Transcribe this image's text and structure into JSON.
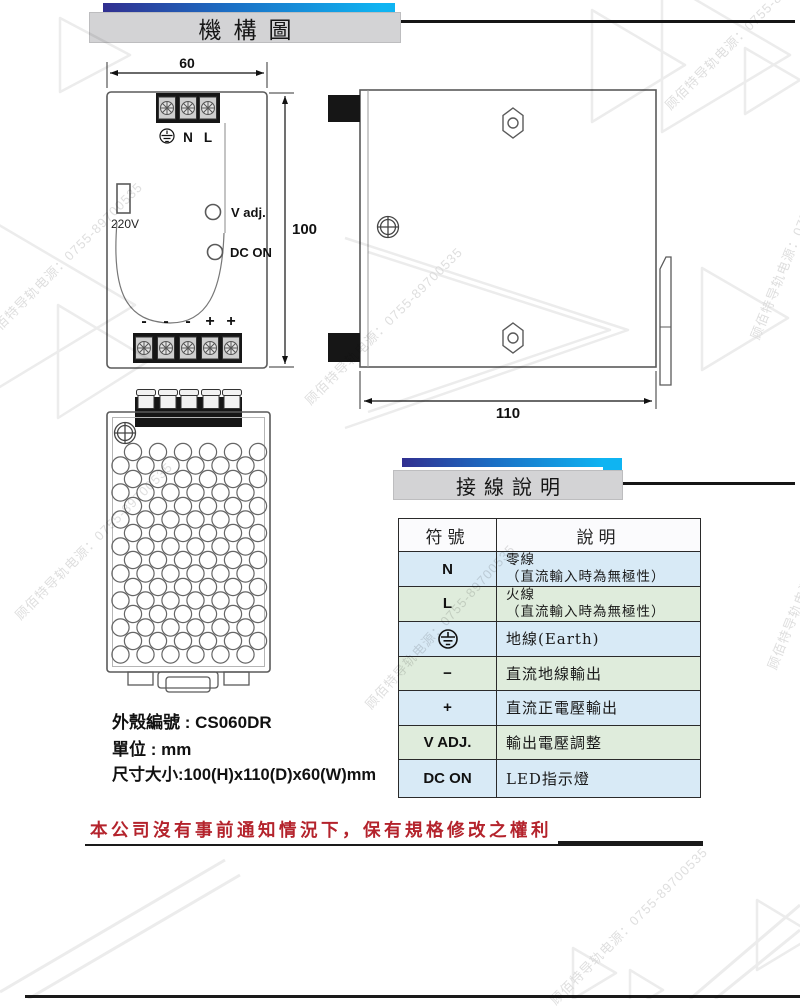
{
  "sections": {
    "mechanical_title": "機構圖",
    "wiring_title": "接線說明"
  },
  "front_view": {
    "dim_width": "60",
    "dim_height": "100",
    "terminal_n": "N",
    "terminal_l": "L",
    "terminal_earth_icon": "earth-ground-icon",
    "voltage_label": "220V",
    "vadj_label": "V adj.",
    "dcon_label": "DC ON",
    "bottom_labels": [
      "-",
      "-",
      "-",
      "+",
      "+"
    ]
  },
  "side_view": {
    "dim_depth": "110",
    "icons": [
      "hex-nut-icon",
      "crosshead-screw-icon",
      "din-rail-clip"
    ]
  },
  "bottom_view": {
    "icons": [
      "crosshead-screw-icon",
      "vent-holes",
      "din-rail-clip-tabs"
    ]
  },
  "info": {
    "case_line": "外殼編號 : CS060DR",
    "unit_line": "單位 : mm",
    "size_line": "尺寸大小:100(H)x110(D)x60(W)mm"
  },
  "table": {
    "header_symbol": "符號",
    "header_desc": "說明",
    "rows": [
      {
        "symbol": "N",
        "desc1": "零線",
        "desc2": "（直流輸入時為無極性）"
      },
      {
        "symbol": "L",
        "desc1": "火線",
        "desc2": "（直流輸入時為無極性）"
      },
      {
        "symbol_icon": "earth-ground-icon",
        "desc1": "地線(Earth)",
        "desc2": ""
      },
      {
        "symbol": "−",
        "desc1": "直流地線輸出",
        "desc2": ""
      },
      {
        "symbol": "+",
        "desc1": "直流正電壓輸出",
        "desc2": ""
      },
      {
        "symbol": "V ADJ.",
        "desc1": "輸出電壓調整",
        "desc2": ""
      },
      {
        "symbol": "DC ON",
        "desc1": "LED指示燈",
        "desc2": ""
      }
    ]
  },
  "notice": "本公司沒有事前通知情況下，保有規格修改之權利",
  "watermark": {
    "text": "顾佰特导轨电源：0755-89700535"
  },
  "colors": {
    "accent_blue": "#0fb4f2",
    "navy": "#312f90",
    "header_gray": "#d3d3d5",
    "table_row_blue": "#d8eaf6",
    "table_row_green": "#dfecdc",
    "notice_red": "#b4232c"
  }
}
